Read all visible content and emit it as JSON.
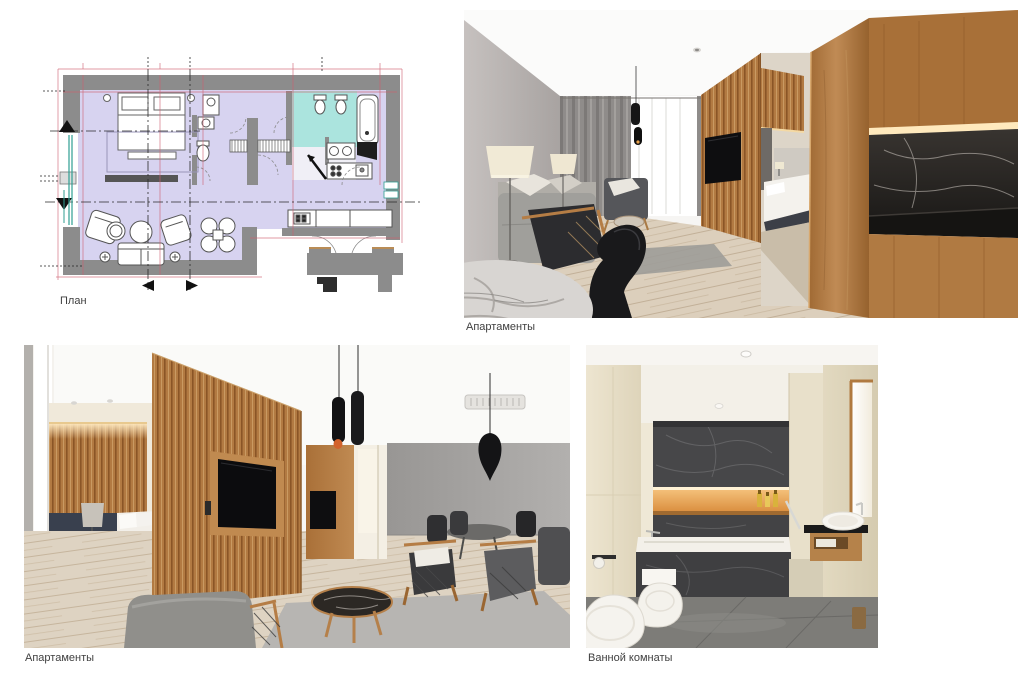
{
  "page": {
    "background_color": "#ffffff"
  },
  "palette": {
    "page_bg": "#ffffff",
    "caption_color": "#3f3f3f",
    "plan_floor_lavender": "#d7d3f0",
    "plan_bathroom_cyan": "#abe4de",
    "plan_wall_gray": "#8c8c8c",
    "plan_dimension_red": "#cf5f6f",
    "plan_axis_black": "#2a2a2a",
    "plan_window_teal": "#2f9e92",
    "render_wood": "#b27a42",
    "render_wood_dark": "#8a5526",
    "render_marble_dark": "#2b2926",
    "render_stone_cream": "#e9e1cd",
    "render_wall_gray": "#b7b2b0",
    "render_floor_wood": "#dccfbc",
    "render_warm_light": "#f2c27c"
  },
  "figures": {
    "plan": {
      "caption": "План"
    },
    "living_render": {
      "caption": "Апартаменты"
    },
    "bedroom_render": {
      "caption": "Апартаменты"
    },
    "bathroom_render": {
      "caption": "Ванной комнаты"
    }
  }
}
